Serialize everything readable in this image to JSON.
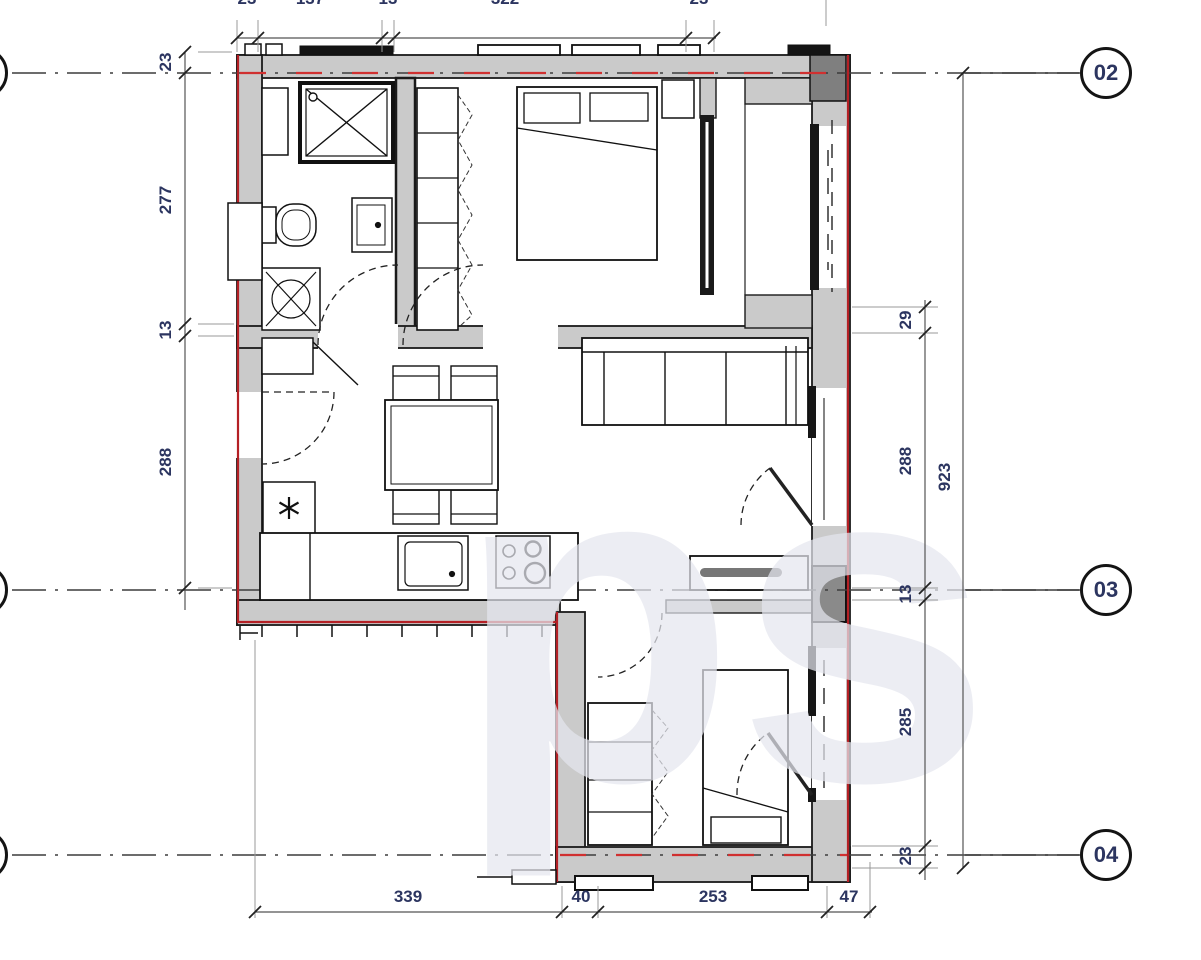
{
  "title": "apartment floor plan section between grid lines 02-04",
  "grid_markers": {
    "m02": "02",
    "m03": "03",
    "m04": "04"
  },
  "dims": {
    "top": [
      "23",
      "137",
      "13",
      "322",
      "23"
    ],
    "left": [
      "23",
      "277",
      "13",
      "288"
    ],
    "right": [
      "29",
      "288",
      "13",
      "285",
      "23"
    ],
    "right_total": "923",
    "bottom": [
      "339",
      "40",
      "253",
      "47"
    ]
  },
  "colors": {
    "wall_fill": "#cacaca",
    "outline": "#1a1a1a",
    "red_accent": "#b42025",
    "red_dash": "#d03030",
    "dim_text": "#2c3560",
    "column_dark": "#7f7f7f",
    "watermark": "#e6e8ef"
  },
  "elements": [
    "shower",
    "toilet",
    "washbasin",
    "washing-machine",
    "duct-shaft",
    "shelf-wardrobe",
    "double-bed",
    "pillows",
    "nightstand",
    "loggia-window",
    "sofa",
    "sideboard",
    "dining-table",
    "chairs",
    "fridge",
    "kitchen-counter",
    "sink",
    "cooktop",
    "entry-door",
    "interior-doors",
    "balcony-doors",
    "single-bed",
    "closet",
    "watermark-logo"
  ]
}
